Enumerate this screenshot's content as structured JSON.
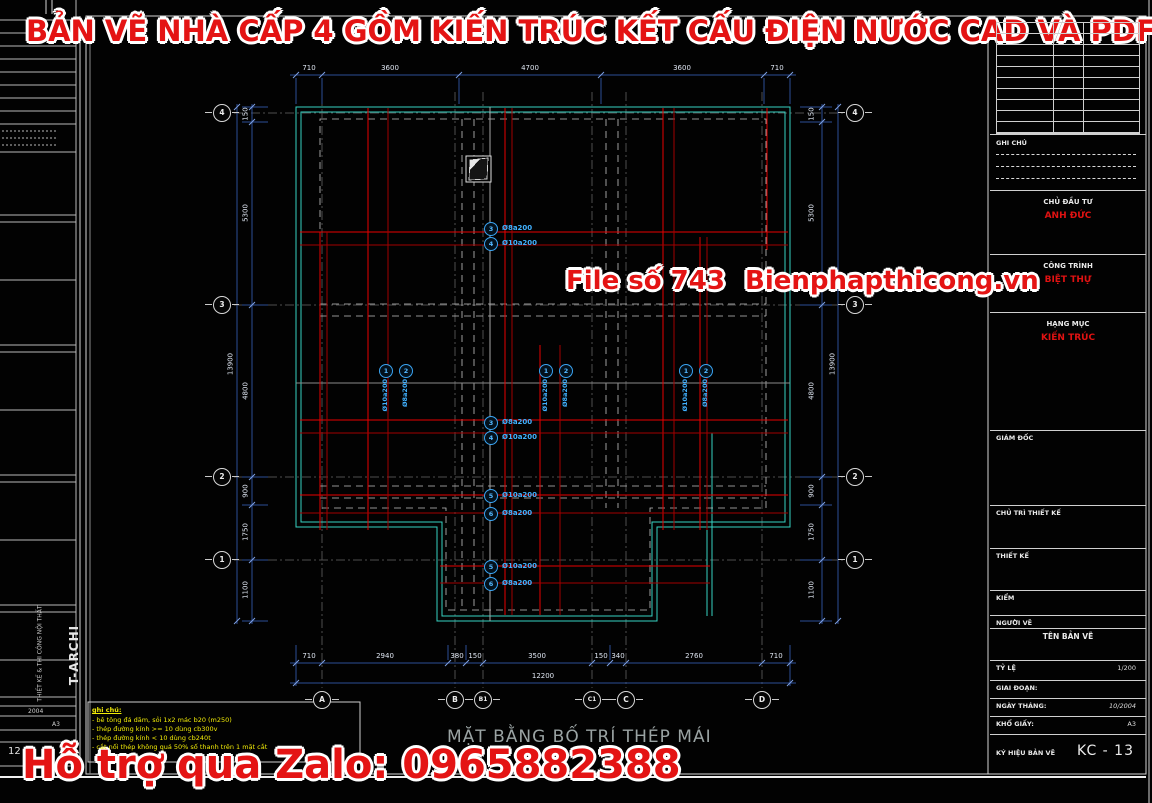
{
  "banner": {
    "top_title": "BẢN VẼ NHÀ CẤP 4 GỒM KIẾN TRÚC KẾT CẤU ĐIỆN NƯỚC CAD VÀ PDF",
    "watermark_file": "File số 743",
    "watermark_site": "Bienphapthicong.vn",
    "bottom_support": "Hỗ trợ qua Zalo: 0965882388"
  },
  "left_sheet": {
    "date": "2004",
    "paper": "A3",
    "number": "12",
    "brand_small": "THIẾT KẾ & THI CÔNG NỘI THẤT",
    "brand_large": "T-ARCHI"
  },
  "notes": {
    "header": "ghi chú:",
    "line1": "- bê tông đá dăm, sỏi 1x2 mác b20 (m250)",
    "line2": "- thép đường kính >= 10 dùng cb300v",
    "line3": "- thép đường kính < 10 dùng cb240t",
    "line4": "- cắt nối thép không quá 50% số thanh trên 1 mặt cắt"
  },
  "plan": {
    "title": "MẶT BẰNG BỐ TRÍ THÉP MÁI",
    "dims_top": [
      "710",
      "3600",
      "4700",
      "3600",
      "710"
    ],
    "dims_bottom": [
      "710",
      "2940",
      "380",
      "150",
      "3500",
      "150",
      "340",
      "2760",
      "710"
    ],
    "total_bottom": "12200",
    "dims_left": [
      "150",
      "5300",
      "4800",
      "900",
      "1750",
      "1100"
    ],
    "total_left": "13900",
    "dims_right": [
      "150",
      "5300",
      "4800",
      "900",
      "1750",
      "1100"
    ],
    "total_right": "13900",
    "rows": [
      "4",
      "3",
      "2",
      "1"
    ],
    "cols": [
      "A",
      "B",
      "B1",
      "C1",
      "C",
      "D"
    ],
    "callouts_h": [
      {
        "n": "3",
        "label": "Ø8a200"
      },
      {
        "n": "4",
        "label": "Ø10a200"
      },
      {
        "n": "3",
        "label": "Ø8a200"
      },
      {
        "n": "4",
        "label": "Ø10a200"
      },
      {
        "n": "5",
        "label": "Ø10a200"
      },
      {
        "n": "6",
        "label": "Ø8a200"
      },
      {
        "n": "5",
        "label": "Ø10a200"
      },
      {
        "n": "6",
        "label": "Ø8a200"
      }
    ],
    "callouts_v": [
      {
        "n": "1",
        "label": "Ø10a200"
      },
      {
        "n": "2",
        "label": "Ø8a200"
      }
    ]
  },
  "titleblock": {
    "notes_label": "GHI CHÚ",
    "investor_label": "CHỦ ĐẦU TƯ",
    "investor": "ANH ĐỨC",
    "project_label": "CÔNG TRÌNH",
    "project": "BIỆT THỰ",
    "category_label": "HẠNG MỤC",
    "category": "KIẾN TRÚC",
    "director_label": "GIÁM ĐỐC",
    "lead_label": "CHỦ TRÌ THIẾT KẾ",
    "design_label": "THIẾT KẾ",
    "check_label": "KIỂM",
    "drafter_label": "NGƯỜI VẼ",
    "drawing_name_label": "TÊN BẢN VẼ",
    "scale_label": "TỶ LỆ",
    "scale_value": "1/200",
    "stage_label": "GIAI ĐOẠN:",
    "date_label": "NGÀY THÁNG:",
    "date_value": "10/2004",
    "paper_label": "KHỔ GIẤY:",
    "paper_value": "A3",
    "code_label": "KÝ HIỆU BẢN VẼ",
    "code_value": "KC - 13"
  }
}
